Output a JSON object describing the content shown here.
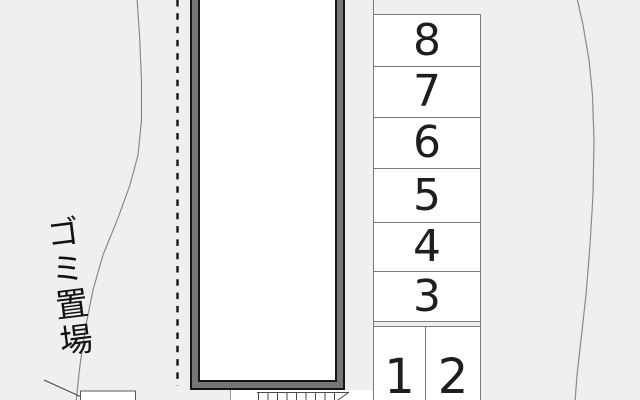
{
  "map": {
    "description_label": "ゴミ置場",
    "garbage_area_label": "ゴミ置場",
    "spaces": [
      {
        "label": "8"
      },
      {
        "label": "7"
      },
      {
        "label": "6"
      },
      {
        "label": "5"
      },
      {
        "label": "4"
      },
      {
        "label": "3"
      },
      {
        "label": "1"
      },
      {
        "label": "2"
      }
    ]
  },
  "colors": {
    "background": "#f0efee",
    "building_border_fill": "#767676",
    "outline": "#161616",
    "space_fill": "#ffffff",
    "space_border": "#7b7b7b",
    "digit": "#1e1e1e",
    "boundary_line": "#8a8a8a"
  }
}
